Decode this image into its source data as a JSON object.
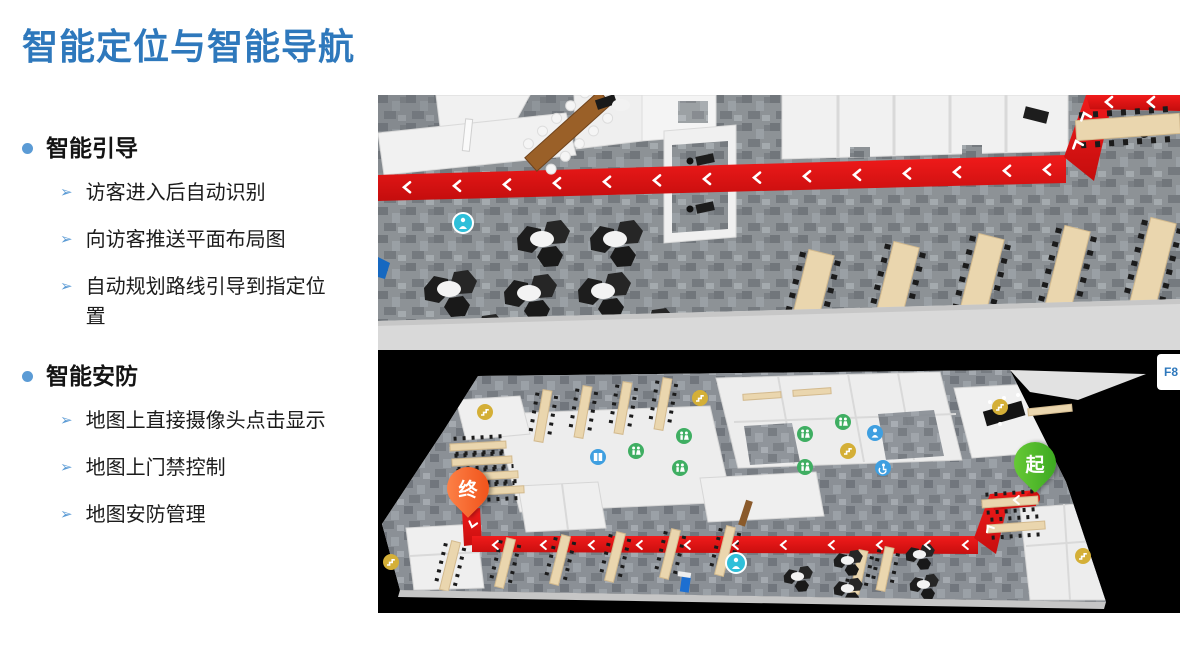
{
  "title": "智能定位与智能导航",
  "ui": {
    "bullet_arrow": "➢"
  },
  "sections": [
    {
      "heading": "智能引导",
      "items": [
        "访客进入后自动识别",
        "向访客推送平面布局图",
        "自动规划路线引导到指定位置"
      ]
    },
    {
      "heading": "智能安防",
      "items": [
        "地图上直接摄像头点击显示",
        "地图上门禁控制",
        "地图安防管理"
      ]
    }
  ],
  "map": {
    "floor_label": "F8",
    "start_marker_label": "起",
    "end_marker_label": "终",
    "colors": {
      "route_red": "#e31414",
      "start_green": "#4caf2e",
      "end_orange": "#f05123",
      "title_blue": "#2e78bc",
      "bullet_blue": "#5b9bd5"
    }
  }
}
